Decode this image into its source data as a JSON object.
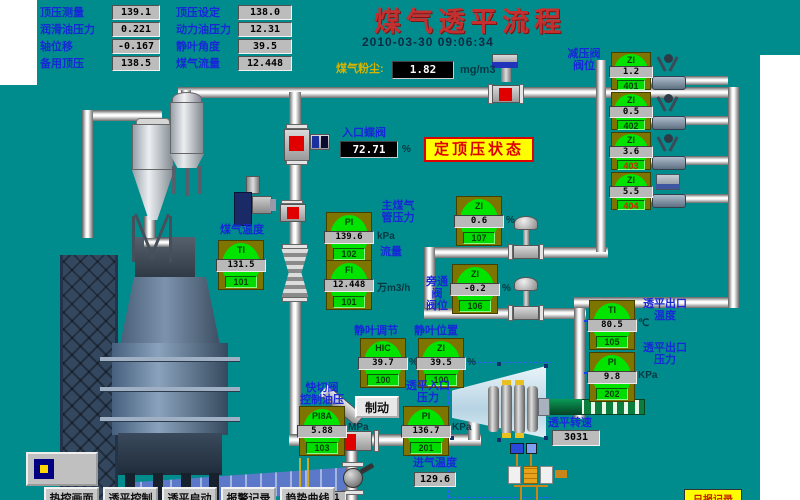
{
  "title": "煤气透平流程",
  "datetime": "2010-03-30 09:06:34",
  "status_banner": "定顶压状态",
  "top_panel": {
    "col1": [
      {
        "label": "顶压测量",
        "value": "139.1"
      },
      {
        "label": "润滑油压力",
        "value": "0.221"
      },
      {
        "label": "轴位移",
        "value": "-0.167"
      },
      {
        "label": "备用顶压",
        "value": "138.5"
      }
    ],
    "col2": [
      {
        "label": "顶压设定",
        "value": "138.0"
      },
      {
        "label": "动力油压力",
        "value": "12.31"
      },
      {
        "label": "静叶角度",
        "value": "39.5"
      },
      {
        "label": "煤气流量",
        "value": "12.448"
      }
    ]
  },
  "dust": {
    "label": "煤气粉尘:",
    "value": "1.82",
    "unit": "mg/m3"
  },
  "inlet_valve": {
    "label": "入口蝶阀",
    "value": "72.71",
    "unit": "%"
  },
  "reducer_group": {
    "label1": "减压阀",
    "label2": "阀位",
    "valves": [
      {
        "tag": "ZI",
        "value": "1.2",
        "id": "401"
      },
      {
        "tag": "ZI",
        "value": "0.5",
        "id": "402"
      },
      {
        "tag": "ZI",
        "value": "3.6",
        "id": "403"
      },
      {
        "tag": "ZI",
        "value": "5.5",
        "id": "404"
      }
    ]
  },
  "instruments": {
    "gas_temp": {
      "label": "煤气温度",
      "tag": "TI",
      "value": "131.5",
      "id": "101"
    },
    "main_press": {
      "label1": "主煤气",
      "label2": "管压力",
      "tag": "PI",
      "value": "139.6",
      "unit": "kPa",
      "id": "102"
    },
    "flow": {
      "label": "流量",
      "tag": "FI",
      "value": "12.448",
      "unit": "万m3/h",
      "id": "101"
    },
    "zi_top": {
      "tag": "ZI",
      "value": "0.6",
      "unit": "%",
      "id": "107"
    },
    "bypass": {
      "label1": "旁通阀",
      "label2": "阀位",
      "tag": "ZI",
      "value": "-0.2",
      "unit": "%",
      "id": "106"
    },
    "vane_ctrl": {
      "label": "静叶调节",
      "tag": "HIC",
      "value": "39.7",
      "unit": "%",
      "id": "100"
    },
    "vane_pos": {
      "label": "静叶位置",
      "tag": "ZI",
      "value": "39.5",
      "unit": "%",
      "id": "100"
    },
    "quick_oil": {
      "label1": "快切阀",
      "label2": "控制油压",
      "tag": "PI8A",
      "value": "5.88",
      "unit": "MPa",
      "id": "103"
    },
    "inlet_press": {
      "label1": "透平入口",
      "label2": "压力",
      "tag": "PI",
      "value": "136.7",
      "unit": "KPa",
      "id": "201"
    },
    "outlet_temp": {
      "label1": "透平出口",
      "label2": "温度",
      "tag": "TI",
      "value": "80.5",
      "unit": "℃",
      "id": "105"
    },
    "outlet_press": {
      "label1": "透平出口",
      "label2": "压力",
      "tag": "PI",
      "value": "9.8",
      "unit": "KPa",
      "id": "202"
    }
  },
  "turbine": {
    "speed_label": "透平转速",
    "speed": "3031"
  },
  "intake_temp": {
    "label": "进气温度",
    "value": "129.6"
  },
  "bottom_partial_value": "131.1",
  "brake_button": "制动",
  "nav_buttons": [
    "热控画面",
    "透平控制",
    "透平启动",
    "报警记录",
    "趋势曲线"
  ],
  "report_button": "日报记录",
  "colors": {
    "background": "#008C8C",
    "block_olive": "#7D7500",
    "indicator_green": "#00E400",
    "banner_yellow": "#FFFF00",
    "alarm_red": "#DD0000",
    "title_red": "#C43030"
  }
}
